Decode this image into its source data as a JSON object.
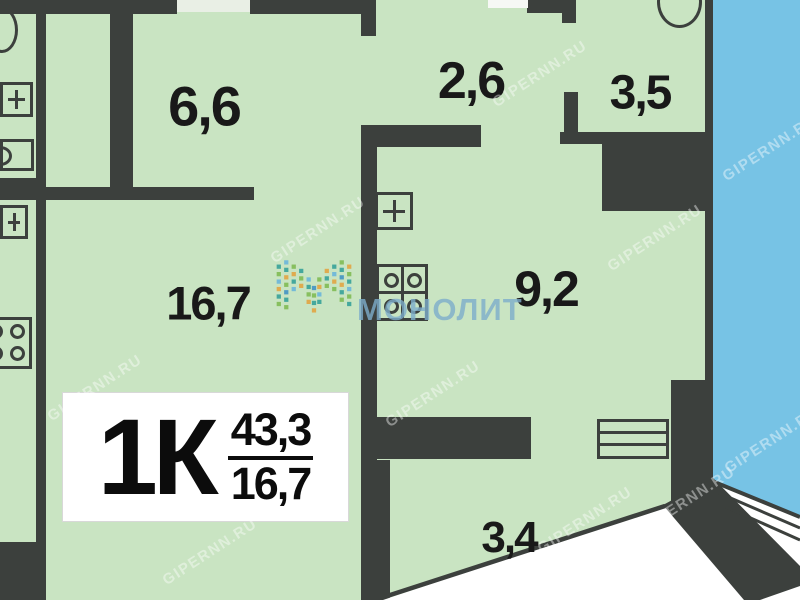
{
  "plan": {
    "unit_label": "1К",
    "areas": {
      "total": "43,3",
      "living": "16,7"
    },
    "rooms": [
      {
        "id": "room-6-6",
        "area_label": "6,6"
      },
      {
        "id": "room-2-6",
        "area_label": "2,6"
      },
      {
        "id": "room-3-5",
        "area_label": "3,5"
      },
      {
        "id": "room-16-7",
        "area_label": "16,7"
      },
      {
        "id": "room-9-2",
        "area_label": "9,2"
      },
      {
        "id": "room-3-4",
        "area_label": "3,4"
      }
    ],
    "watermarks": {
      "site": "GIPERNN.RU",
      "developer": "МОНОЛИТ"
    },
    "icons": [
      {
        "name": "toilet-icon",
        "shape": "ellipse-outline"
      },
      {
        "name": "plus-fixture-icon",
        "shape": "square-with-plus"
      },
      {
        "name": "sink-icon",
        "shape": "box-with-circle"
      },
      {
        "name": "stove-icon",
        "shape": "box-with-four-burners"
      },
      {
        "name": "radiator-icon",
        "shape": "box-with-horizontal-lines"
      }
    ],
    "colors": {
      "floor": "#c9e4c2",
      "wall": "#3c403d",
      "water": "#77c3e5",
      "label_bg": "#ffffff",
      "monolit_blue": "#7dacCB"
    }
  }
}
